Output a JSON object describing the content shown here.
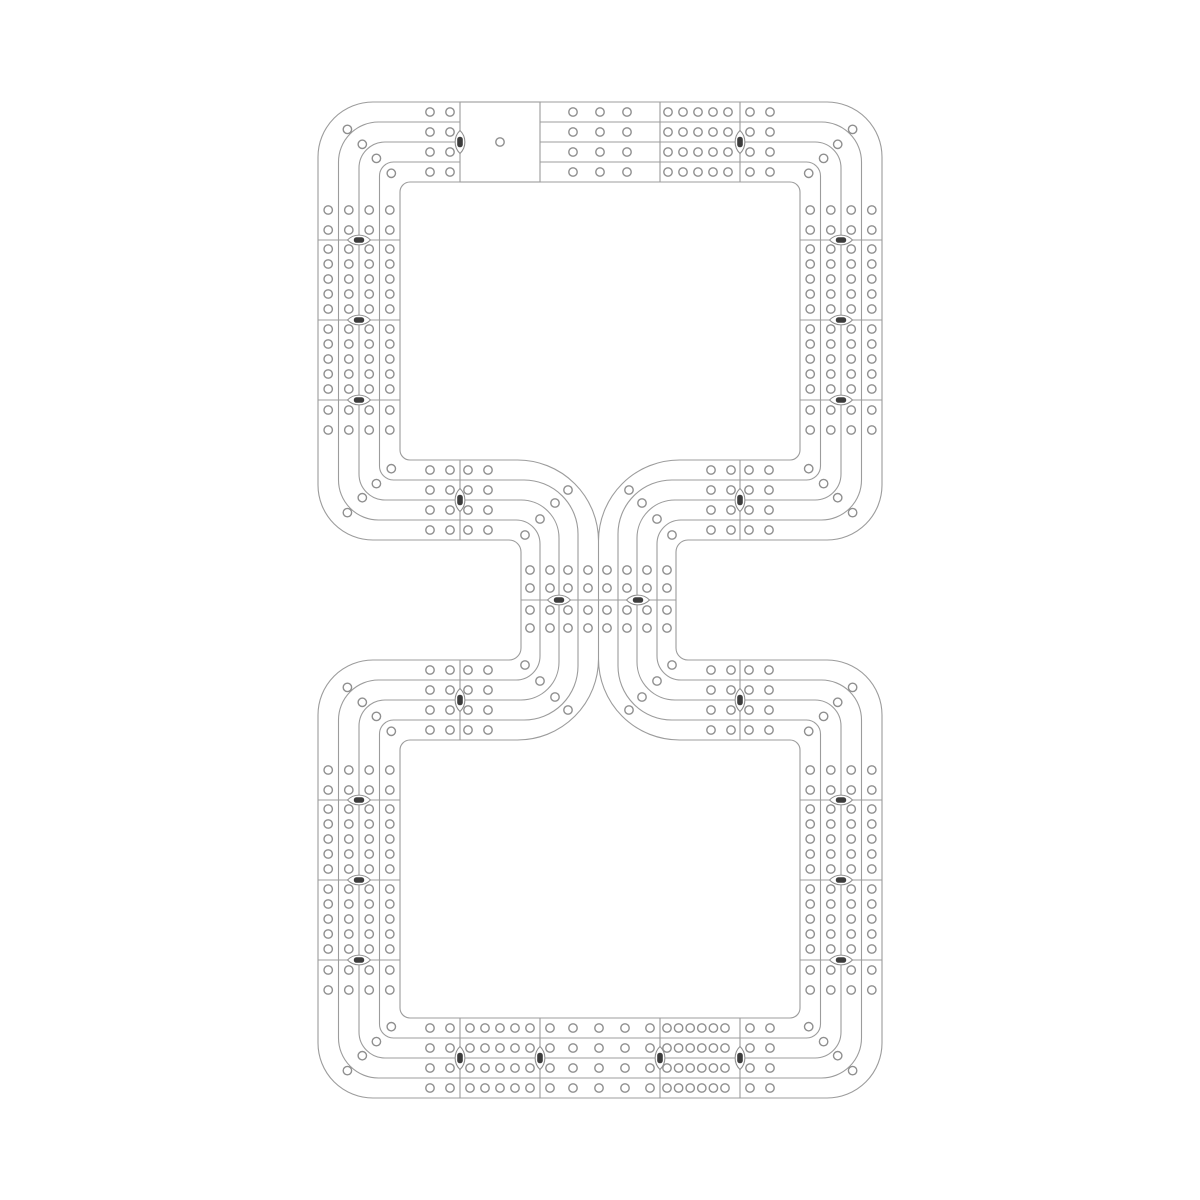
{
  "diagram": {
    "canvas": {
      "width": 1200,
      "height": 1200,
      "background": "#ffffff"
    },
    "style": {
      "line_color": "#9c9c9c",
      "line_width": 1.1,
      "hole": {
        "radius": 4.2,
        "stroke": "#8f8f8f",
        "stroke_width": 1.4,
        "fill": "#ffffff"
      },
      "marker": {
        "half_len": 11.5,
        "arc_r": 16,
        "core_w": 10.4,
        "core_h": 5.6,
        "core_rx": 2.6,
        "core_color": "#3d3d3d",
        "fill": "#ffffff",
        "stroke": "#8f8f8f"
      }
    },
    "loop_x": {
      "left": [
        318,
        338.5,
        359,
        379.5,
        400
      ],
      "right": [
        882,
        861.5,
        841,
        820.5,
        800
      ],
      "corner_r": [
        55,
        40,
        26,
        14,
        10
      ]
    },
    "top_loop_y": {
      "top": [
        102,
        122,
        142,
        162,
        182
      ],
      "bottom": [
        540,
        520,
        500,
        480,
        460
      ]
    },
    "bottom_loop_y": {
      "top": [
        660,
        680,
        700,
        720,
        740
      ],
      "bottom": [
        1098,
        1078,
        1058,
        1038,
        1018
      ]
    },
    "waist": {
      "left_lines": [
        521,
        540,
        559,
        578,
        598.5
      ],
      "right_lines": [
        676,
        657,
        637,
        618,
        598.5
      ],
      "fillet_r": [
        12,
        24,
        38,
        54,
        81
      ],
      "center_x": 598.5,
      "cusp_top": 541,
      "cusp_bottom": 659,
      "divider": {
        "y": 600,
        "x1": 521,
        "x2": 676
      },
      "grid_cols": [
        530,
        550,
        568,
        588,
        607,
        627,
        647,
        667
      ],
      "grid_rows": [
        570,
        588,
        610,
        628
      ]
    },
    "start_box": {
      "x": 460,
      "y": 102,
      "w": 80,
      "h": 80,
      "hole": [
        500,
        142
      ]
    },
    "dividers": [
      [
        660,
        102,
        660,
        182
      ],
      [
        740,
        102,
        740,
        182
      ],
      [
        318,
        240,
        400,
        240
      ],
      [
        318,
        320,
        400,
        320
      ],
      [
        318,
        400,
        400,
        400
      ],
      [
        800,
        240,
        882,
        240
      ],
      [
        800,
        320,
        882,
        320
      ],
      [
        800,
        400,
        882,
        400
      ],
      [
        460,
        460,
        460,
        540
      ],
      [
        740,
        460,
        740,
        540
      ],
      [
        460,
        660,
        460,
        740
      ],
      [
        740,
        660,
        740,
        740
      ],
      [
        318,
        800,
        400,
        800
      ],
      [
        318,
        880,
        400,
        880
      ],
      [
        318,
        960,
        400,
        960
      ],
      [
        800,
        800,
        882,
        800
      ],
      [
        800,
        880,
        882,
        880
      ],
      [
        800,
        960,
        882,
        960
      ],
      [
        460,
        1018,
        460,
        1098
      ],
      [
        540,
        1018,
        540,
        1098
      ],
      [
        660,
        1018,
        660,
        1098
      ],
      [
        740,
        1018,
        740,
        1098
      ]
    ],
    "markers": [
      [
        460,
        142,
        "v"
      ],
      [
        740,
        142,
        "v"
      ],
      [
        359,
        240,
        "h"
      ],
      [
        359,
        320,
        "h"
      ],
      [
        359,
        400,
        "h"
      ],
      [
        841,
        240,
        "h"
      ],
      [
        841,
        320,
        "h"
      ],
      [
        841,
        400,
        "h"
      ],
      [
        460,
        500,
        "v"
      ],
      [
        740,
        500,
        "v"
      ],
      [
        559,
        600,
        "h"
      ],
      [
        638,
        600,
        "h"
      ],
      [
        460,
        700,
        "v"
      ],
      [
        740,
        700,
        "v"
      ],
      [
        359,
        800,
        "h"
      ],
      [
        359,
        880,
        "h"
      ],
      [
        359,
        960,
        "h"
      ],
      [
        841,
        800,
        "h"
      ],
      [
        841,
        880,
        "h"
      ],
      [
        841,
        960,
        "h"
      ],
      [
        460,
        1058,
        "v"
      ],
      [
        540,
        1058,
        "v"
      ],
      [
        660,
        1058,
        "v"
      ],
      [
        740,
        1058,
        "v"
      ]
    ],
    "hole_bands": [
      {
        "axis": "h",
        "rows": [
          112,
          132,
          152,
          172
        ],
        "cols": [
          430,
          450,
          573,
          600,
          627,
          668,
          683,
          698,
          713,
          728,
          750,
          770
        ]
      },
      {
        "axis": "h",
        "rows": [
          470,
          490,
          510,
          530
        ],
        "cols": [
          430,
          450,
          468,
          488,
          711,
          731,
          749,
          769
        ]
      },
      {
        "axis": "v",
        "cols": [
          328.2,
          348.8,
          369.2,
          389.8
        ],
        "rows": [
          210,
          230,
          249,
          264,
          279,
          294,
          309,
          329,
          344,
          359,
          374,
          389,
          410,
          430
        ]
      },
      {
        "axis": "v",
        "cols": [
          810.2,
          830.8,
          851.2,
          871.8
        ],
        "rows": [
          210,
          230,
          249,
          264,
          279,
          294,
          309,
          329,
          344,
          359,
          374,
          389,
          410,
          430
        ]
      },
      {
        "axis": "h",
        "rows": [
          670,
          690,
          710,
          730
        ],
        "cols": [
          430,
          450,
          468,
          488,
          711,
          731,
          749,
          769
        ]
      },
      {
        "axis": "v",
        "cols": [
          328.2,
          348.8,
          369.2,
          389.8
        ],
        "rows": [
          770,
          790,
          809,
          824,
          839,
          854,
          869,
          889,
          904,
          919,
          934,
          949,
          970,
          990
        ]
      },
      {
        "axis": "v",
        "cols": [
          810.2,
          830.8,
          851.2,
          871.8
        ],
        "rows": [
          770,
          790,
          809,
          824,
          839,
          854,
          869,
          889,
          904,
          919,
          934,
          949,
          970,
          990
        ]
      },
      {
        "axis": "h",
        "rows": [
          1028,
          1048,
          1068,
          1088
        ],
        "cols": [
          430,
          450,
          470,
          485,
          500,
          515,
          530,
          550,
          573,
          599,
          625,
          650,
          667,
          678.6,
          690.2,
          701.8,
          713.4,
          725,
          750,
          770
        ]
      },
      {
        "axis": "grid",
        "cols": [
          530,
          550,
          568,
          588,
          607,
          627,
          647,
          667
        ],
        "rows": [
          570,
          588,
          610,
          628
        ]
      }
    ],
    "single_holes": [
      [
        347.4,
        129.4
      ],
      [
        362.3,
        144.3
      ],
      [
        376.4,
        158.4
      ],
      [
        391.3,
        173.3
      ],
      [
        852.6,
        129.4
      ],
      [
        837.7,
        144.3
      ],
      [
        823.6,
        158.4
      ],
      [
        808.7,
        173.3
      ],
      [
        347.4,
        512.6
      ],
      [
        362.3,
        497.7
      ],
      [
        376.4,
        483.6
      ],
      [
        391.3,
        468.7
      ],
      [
        852.6,
        512.6
      ],
      [
        837.7,
        497.7
      ],
      [
        823.6,
        483.6
      ],
      [
        808.7,
        468.7
      ],
      [
        347.4,
        687.4
      ],
      [
        362.3,
        702.3
      ],
      [
        376.4,
        716.4
      ],
      [
        391.3,
        731.3
      ],
      [
        852.6,
        687.4
      ],
      [
        837.7,
        702.3
      ],
      [
        823.6,
        716.4
      ],
      [
        808.7,
        731.3
      ],
      [
        347.4,
        1070.6
      ],
      [
        362.3,
        1055.7
      ],
      [
        376.4,
        1041.6
      ],
      [
        391.3,
        1026.7
      ],
      [
        852.6,
        1070.6
      ],
      [
        837.7,
        1055.7
      ],
      [
        823.6,
        1041.6
      ],
      [
        808.7,
        1026.7
      ],
      [
        568,
        490
      ],
      [
        555,
        503
      ],
      [
        540,
        519
      ],
      [
        525,
        535
      ],
      [
        629,
        490
      ],
      [
        642,
        503
      ],
      [
        657,
        519
      ],
      [
        672,
        535
      ],
      [
        568,
        710
      ],
      [
        555,
        697
      ],
      [
        540,
        681
      ],
      [
        525,
        665
      ],
      [
        629,
        710
      ],
      [
        642,
        697
      ],
      [
        657,
        681
      ],
      [
        672,
        665
      ]
    ]
  }
}
